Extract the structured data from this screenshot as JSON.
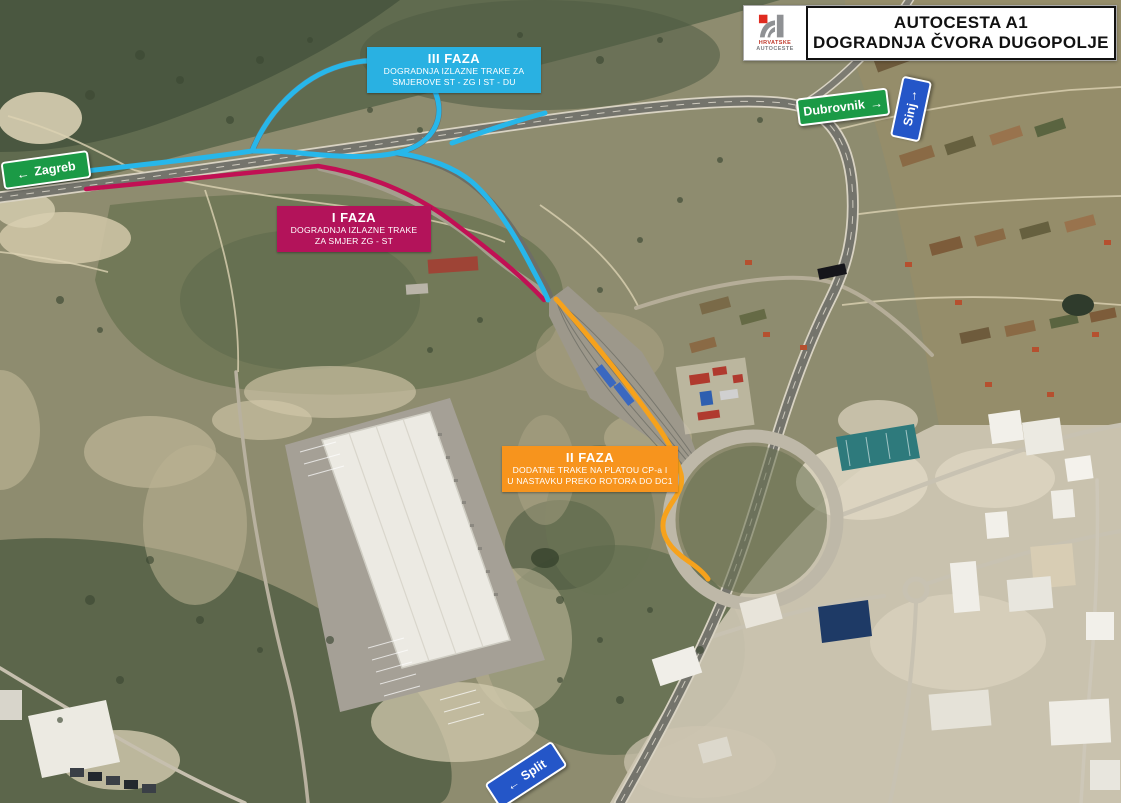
{
  "header": {
    "title_line1": "AUTOCESTA A1",
    "title_line2": "DOGRADNJA ČVORA DUGOPOLJE",
    "logo": {
      "line1": "HRVATSKE",
      "line2": "AUTOCESTE"
    }
  },
  "callouts": {
    "faza1": {
      "title": "I FAZA",
      "line1": "DOGRADNJA IZLAZNE TRAKE",
      "line2": "ZA SMJER ZG - ST",
      "color": "#b3135a"
    },
    "faza2": {
      "title": "II FAZA",
      "line1": "DODATNE TRAKE NA PLATOU CP-a I",
      "line2": "U NASTAVKU PREKO ROTORA DO DC1",
      "color": "#f7941d"
    },
    "faza3": {
      "title": "III FAZA",
      "line1": "DOGRADNJA IZLAZNE TRAKE ZA",
      "line2": "SMJEROVE ST - ZG I ST - DU",
      "color": "#29b1e2"
    }
  },
  "signs": {
    "zagreb": {
      "label": "Zagreb",
      "arrow": "←",
      "color": "#1b9a46"
    },
    "dubrovnik": {
      "label": "Dubrovnik",
      "arrow": "→",
      "color": "#1b9a46"
    },
    "sinj": {
      "label": "Sinj",
      "arrow": "↑",
      "color": "#2456c8"
    },
    "split": {
      "label": "Split",
      "arrow": "←",
      "color": "#2456c8"
    }
  },
  "routes": {
    "faza1_color": "#c11054",
    "faza2_color": "#f6a21c",
    "faza3_color": "#27b7ea"
  }
}
